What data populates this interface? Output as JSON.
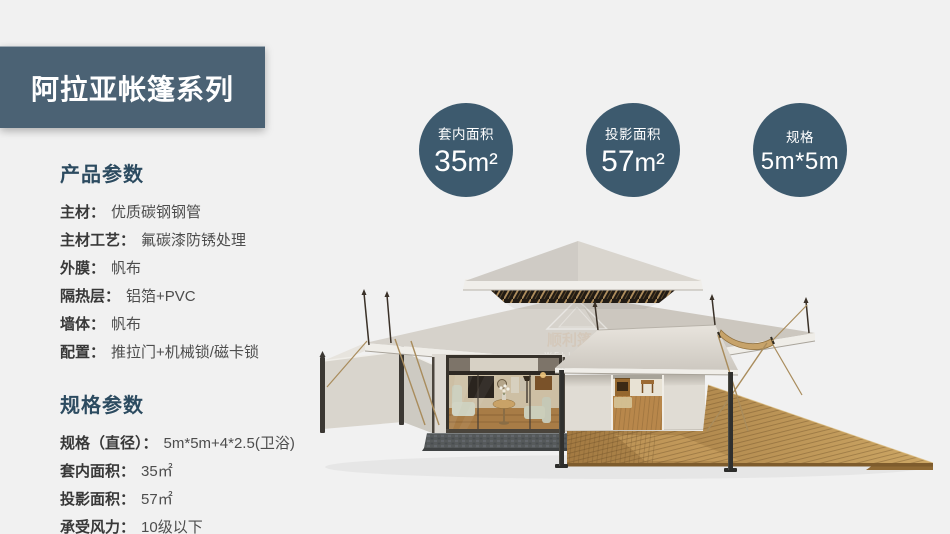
{
  "banner": {
    "title": "阿拉亚帐篷系列"
  },
  "badges": [
    {
      "label": "套内面积",
      "num": "35",
      "unit": "m²"
    },
    {
      "label": "投影面积",
      "num": "57",
      "unit": "m²"
    },
    {
      "label": "规格",
      "num": "5m*5m",
      "unit": ""
    }
  ],
  "product_params": {
    "heading": "产品参数",
    "items": [
      {
        "label": "主材：",
        "value": "优质碳钢钢管"
      },
      {
        "label": "主材工艺：",
        "value": "氟碳漆防锈处理"
      },
      {
        "label": "外膜：",
        "value": "帆布"
      },
      {
        "label": "隔热层：",
        "value": "铝箔+PVC"
      },
      {
        "label": "墙体：",
        "value": "帆布"
      },
      {
        "label": "配置：",
        "value": "推拉门+机械锁/磁卡锁"
      }
    ]
  },
  "spec_params": {
    "heading": "规格参数",
    "items": [
      {
        "label": "规格（直径）：",
        "value": "5m*5m+4*2.5(卫浴)"
      },
      {
        "label": "套内面积：",
        "value": "35㎡"
      },
      {
        "label": "投影面积：",
        "value": "57㎡"
      },
      {
        "label": "承受风力：",
        "value": "10级以下"
      }
    ]
  },
  "tent": {
    "watermark_cn": "顺利篷房",
    "watermark_en": "WELL-TENT"
  },
  "colors": {
    "page_bg": "#f1f1f1",
    "banner_bg": "#4b6274",
    "badge_bg": "#3d5a6e",
    "heading_text": "#2c4b60"
  }
}
